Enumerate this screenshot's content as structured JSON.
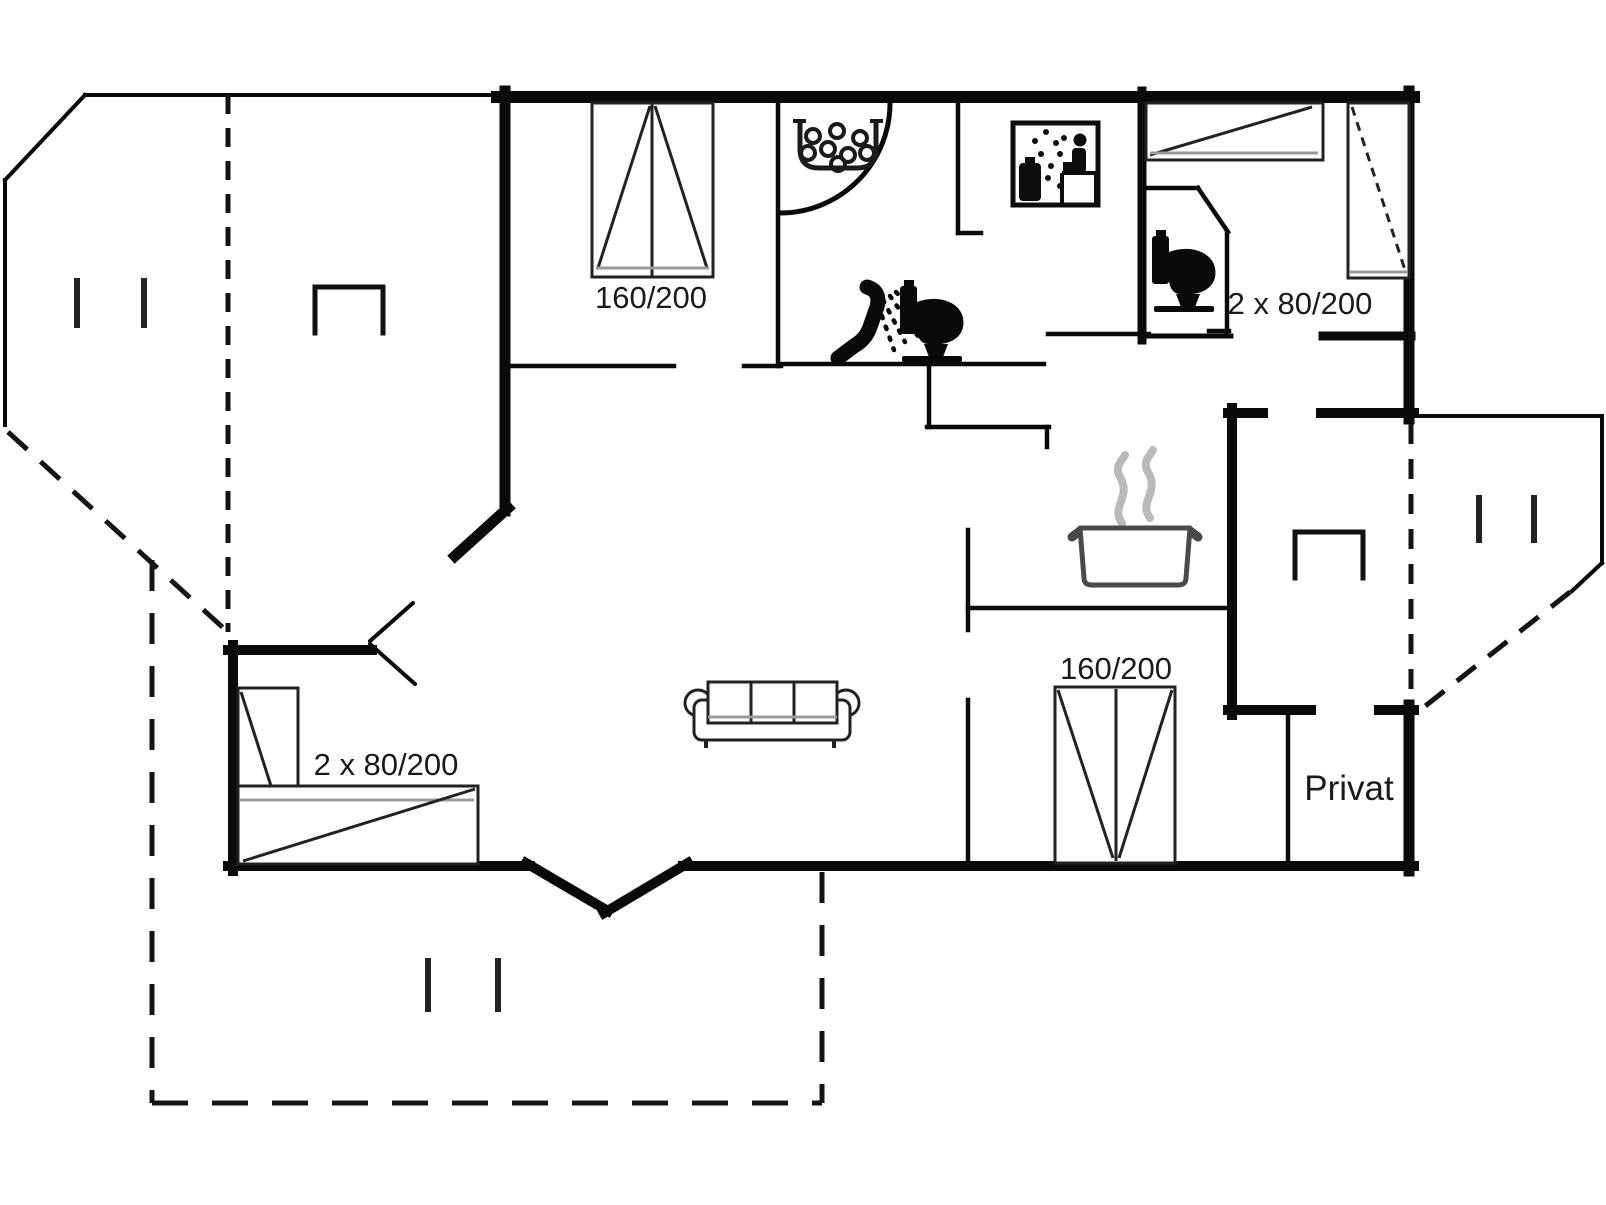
{
  "document": {
    "type": "holiday-home floor plan",
    "background_color": "#ffffff",
    "wall_color": "#0a0a0a",
    "accent_gray": "#999999",
    "steam_gray": "#b9b9b9"
  },
  "labels": {
    "bed_top_left": "160/200",
    "bedroom_top_right": "2 x 80/200",
    "bedroom_bottom_left": "2 x 80/200",
    "bed_bottom_right": "160/200",
    "private_room": "Privat"
  },
  "icons": [
    {
      "name": "whirlpool-corner-bath-icon",
      "meaning": "corner whirlpool tub with bubbles"
    },
    {
      "name": "shower-icon",
      "meaning": "hand shower with spray"
    },
    {
      "name": "toilet-icon",
      "meaning": "toilet in bathroom"
    },
    {
      "name": "sauna-icon",
      "meaning": "sauna room symbol"
    },
    {
      "name": "toilet-icon",
      "meaning": "toilet in separate WC"
    },
    {
      "name": "cooking-pot-icon",
      "meaning": "kitchen / stove"
    },
    {
      "name": "sofa-icon",
      "meaning": "living room sofa"
    },
    {
      "name": "double-bed-icon",
      "meaning": "160/200 double bed, top bedroom"
    },
    {
      "name": "single-bed-icon",
      "meaning": "80/200 single bed horizontal, top right bedroom"
    },
    {
      "name": "single-bed-icon",
      "meaning": "80/200 single bed vertical, top right bedroom"
    },
    {
      "name": "corner-beds-icon",
      "meaning": "2 x 80/200 corner beds, bottom left bedroom"
    },
    {
      "name": "double-bed-icon",
      "meaning": "160/200 double bed, bottom right bedroom"
    },
    {
      "name": "fireplace-icon",
      "meaning": "open-bottom square symbol on left covered terrace"
    },
    {
      "name": "fireplace-icon",
      "meaning": "open-bottom square symbol in right annex"
    },
    {
      "name": "table-marker-icon",
      "meaning": "paired short lines on each terrace (3 terraces)"
    }
  ]
}
